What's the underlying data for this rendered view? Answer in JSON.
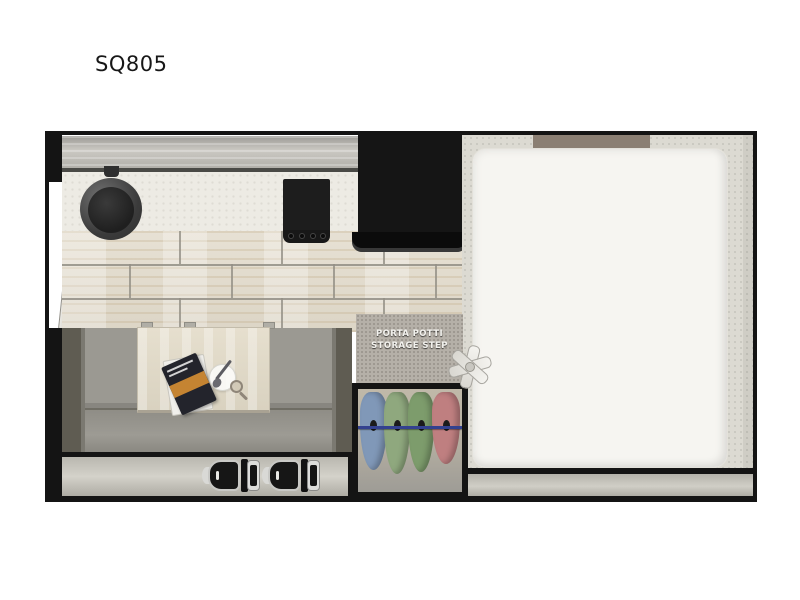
{
  "page": {
    "title": "SQ805",
    "background_color": "#ffffff"
  },
  "floorplan": {
    "model": "SQ805",
    "type_hint": "truck-camper-floor-plan",
    "border_color": "#141414",
    "porta_potti_step": {
      "line1": "PORTA POTTI",
      "line2": "STORAGE STEP",
      "text_color": "#f3f2ee",
      "panel_color": "#b5b0a8"
    },
    "kitchen": {
      "upper_cabinet_color": "#bbb9b3",
      "countertop_color": "#edebe4",
      "sink_color": "#3a3a3a",
      "stove_color": "#1d1d1d",
      "refrigerator_color": "#151515",
      "floor_tile_color": "#e3ddd0"
    },
    "dinette": {
      "sofa_color": "#9b9992",
      "armrest_color": "#5f5c52",
      "table_color": "#ded7c6",
      "items_on_table": [
        "magazines",
        "plate-with-spoon",
        "magnifier"
      ]
    },
    "bedroom": {
      "bed_color": "#f6f5f1",
      "carpet_color": "#dcdad2",
      "headboard_color": "#8b7f73"
    },
    "wardrobe": {
      "rod_color": "#33418f",
      "clothes_colors": [
        "#8098b8",
        "#8fa87e",
        "#7d9c6c",
        "#bf7f80"
      ]
    },
    "cab": {
      "strip_color": "#c7c5bd",
      "seat_color": "#161616",
      "seat_count": 2
    },
    "entry": {
      "door_color": "#d9d7d1"
    }
  }
}
